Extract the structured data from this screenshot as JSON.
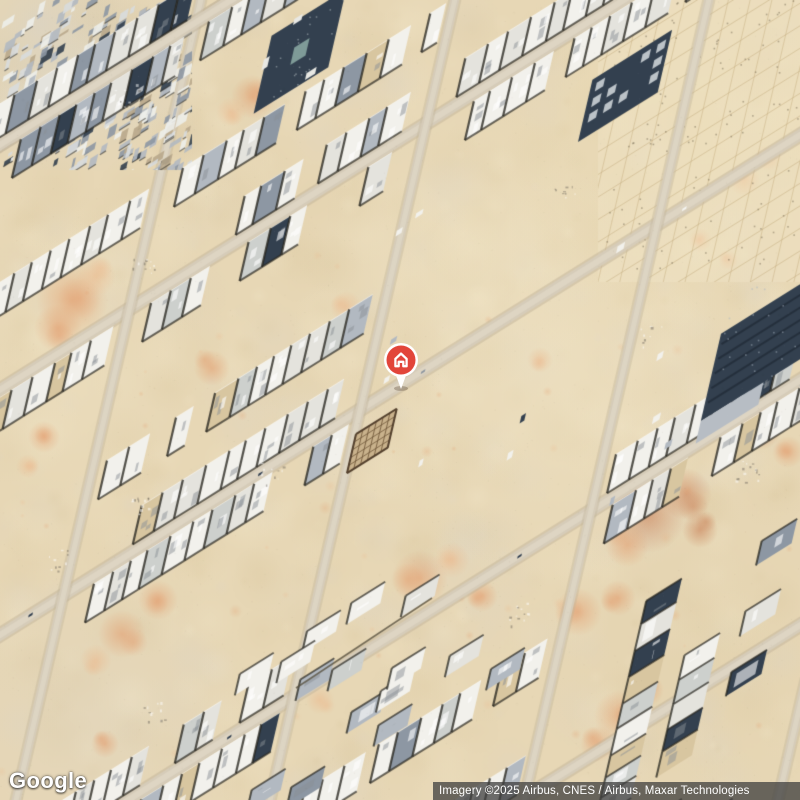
{
  "map": {
    "view_type": "satellite",
    "watermark": {
      "label": "Google"
    },
    "attribution": {
      "text": "Imagery ©2025 Airbus, CNES / Airbus, Maxar Technologies"
    },
    "marker": {
      "kind": "property-location-pin",
      "icon": "home-icon",
      "x_px": 401,
      "y_px": 393,
      "pin_color": "#e2453a",
      "ring_color": "#ffffff"
    },
    "palette": {
      "sand": "#e7d7b5",
      "sand_light": "#f3e8cb",
      "sand_dark": "#d9c69d",
      "sand_gray": "#ddd5c6",
      "road": "#d6ccb9",
      "road_edge": "#c2b49a",
      "building_white": "#f2f1ec",
      "building_light": "#e4e3dd",
      "building_mid": "#cdd0cd",
      "building_gray": "#b2b9c1",
      "building_slate": "#8d97a3",
      "building_navy": "#33404f",
      "tan_unfinished": "#d8c6a0",
      "shadow": "#26251f",
      "orange_light": "#ecb98d",
      "orange": "#e39b6b",
      "orange_deep": "#c87a50",
      "attribution_bg": "#3e3e3e",
      "attribution_fg": "#ffffff"
    }
  }
}
